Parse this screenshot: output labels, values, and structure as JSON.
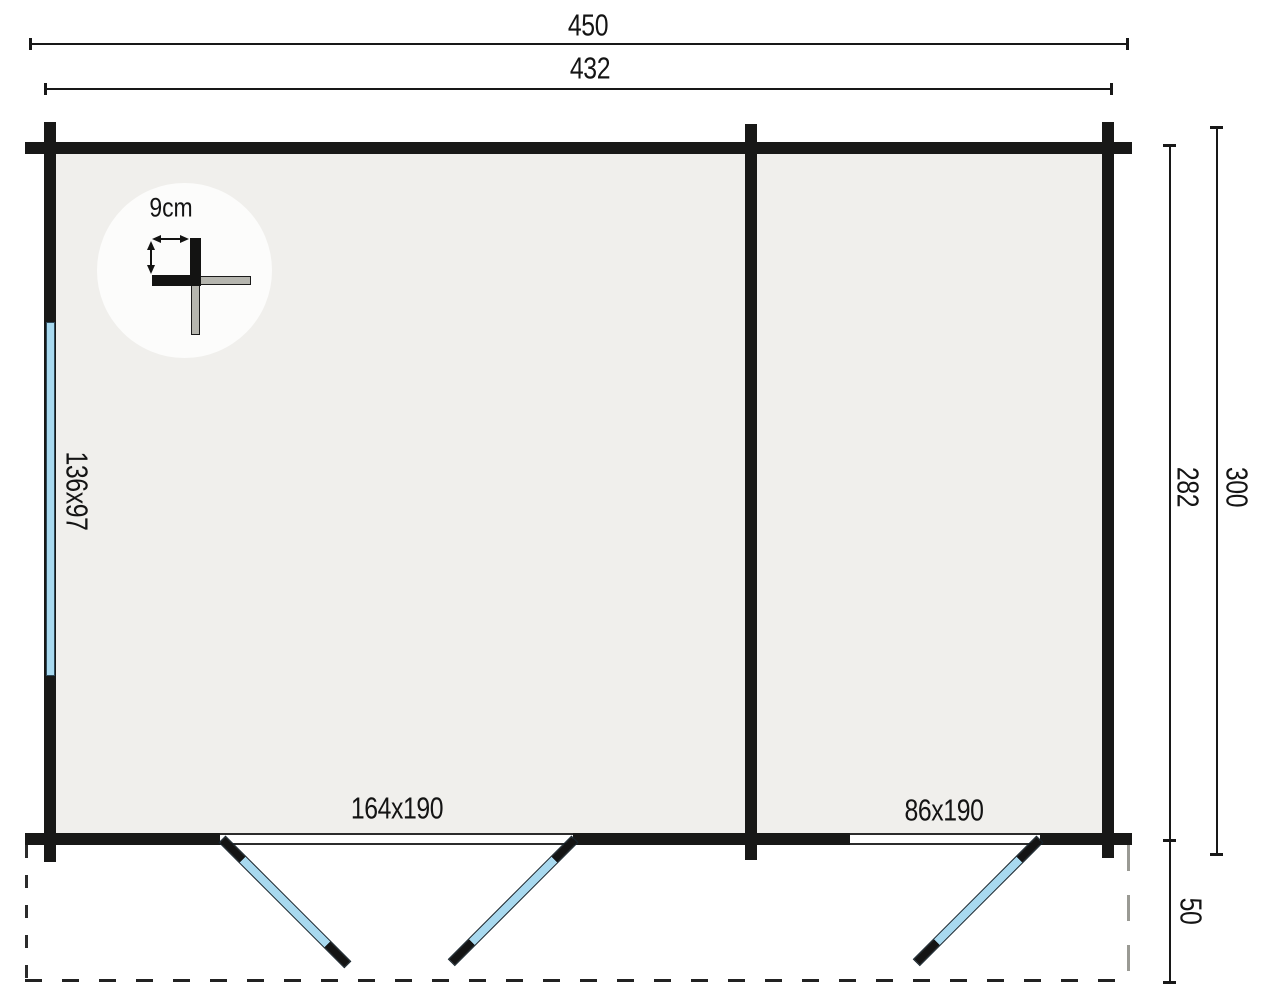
{
  "meta": {
    "drawing_type": "log-cabin floor plan",
    "units": "cm"
  },
  "dimensions": {
    "outer_width": "450",
    "inner_width": "432",
    "outer_depth": "300",
    "inner_depth": "282",
    "terrace_depth": "50"
  },
  "openings": {
    "left_window": "136x97",
    "double_door": "164x190",
    "single_door": "86x190"
  },
  "detail": {
    "wall_thickness": "9cm"
  },
  "colors": {
    "wall": "#181817",
    "room_fill": "#f0efec",
    "glass": "#a8d9ef",
    "glass_outline": "#2e4a5a",
    "log_gray": "#b5b5ae",
    "dash_dark": "#2b2b2b",
    "dash_light": "#9a9a94",
    "dim_line": "#181818"
  }
}
